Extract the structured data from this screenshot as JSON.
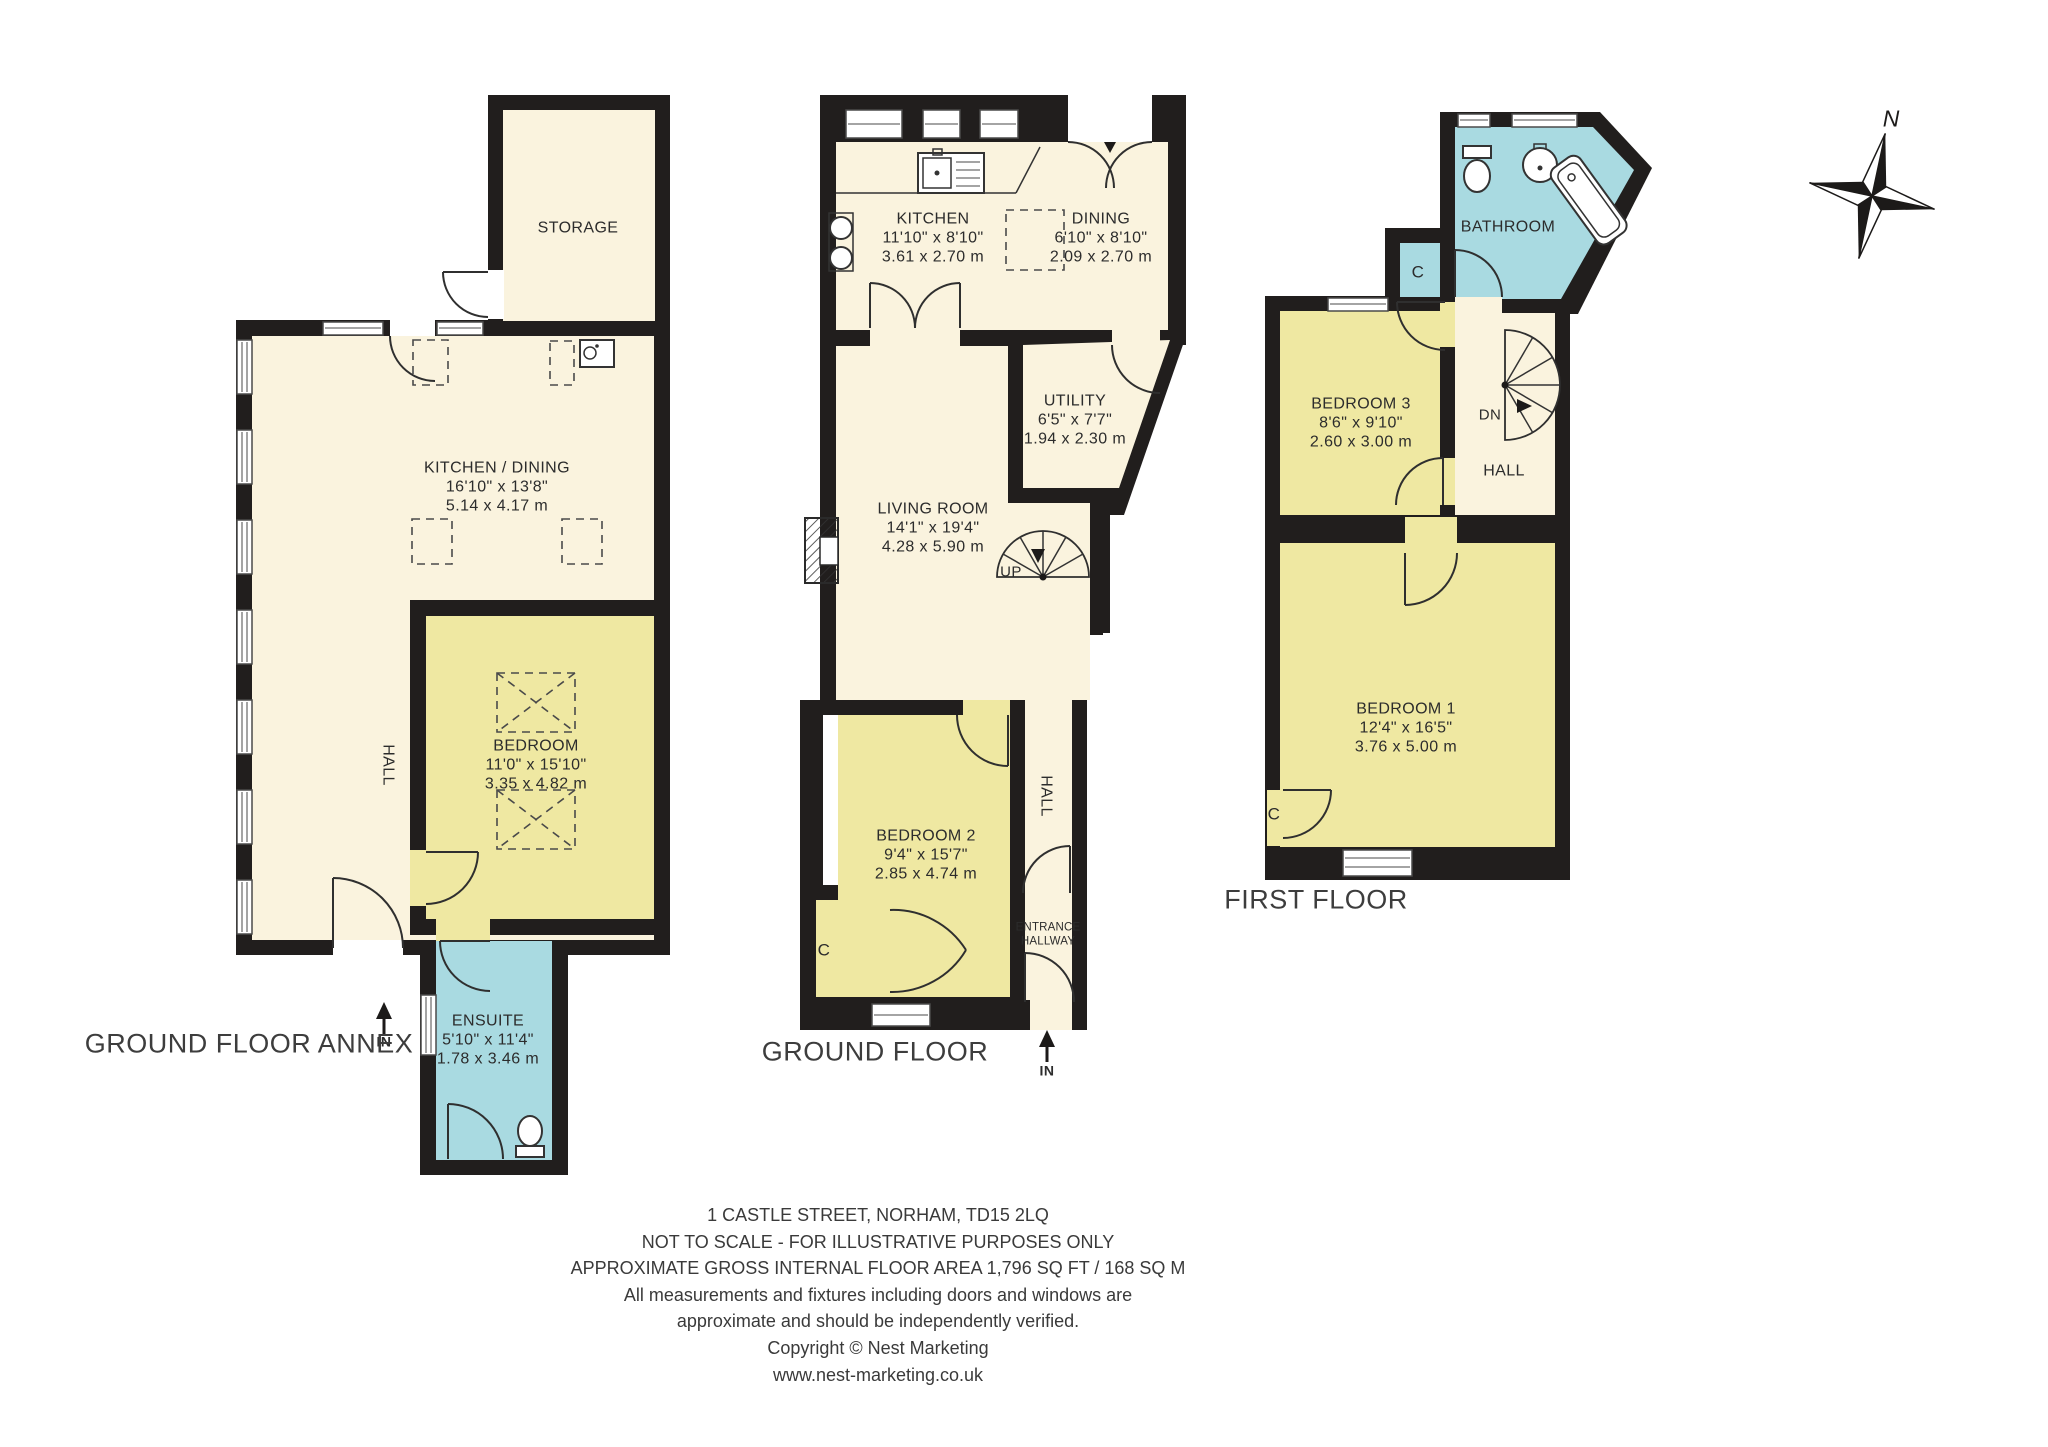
{
  "compass": {
    "north_label": "N"
  },
  "annex": {
    "title": "GROUND FLOOR ANNEX",
    "entry_label": "IN",
    "storage": {
      "name": "STORAGE"
    },
    "kitchen_dining": {
      "name": "KITCHEN / DINING",
      "size_imperial": "16'10\" x 13'8\"",
      "size_metric": "5.14 x 4.17 m"
    },
    "hall": {
      "name": "HALL"
    },
    "bedroom": {
      "name": "BEDROOM",
      "size_imperial": "11'0\" x 15'10\"",
      "size_metric": "3.35 x 4.82 m"
    },
    "ensuite": {
      "name": "ENSUITE",
      "size_imperial": "5'10\" x 11'4\"",
      "size_metric": "1.78 x 3.46 m"
    }
  },
  "ground": {
    "title": "GROUND FLOOR",
    "entry_label": "IN",
    "stairs_label": "UP",
    "closet_label": "C",
    "kitchen": {
      "name": "KITCHEN",
      "size_imperial": "11'10\" x 8'10\"",
      "size_metric": "3.61 x 2.70 m"
    },
    "dining": {
      "name": "DINING",
      "size_imperial": "6'10\" x 8'10\"",
      "size_metric": "2.09 x 2.70 m"
    },
    "utility": {
      "name": "UTILITY",
      "size_imperial": "6'5\" x 7'7\"",
      "size_metric": "1.94 x 2.30 m"
    },
    "living_room": {
      "name": "LIVING ROOM",
      "size_imperial": "14'1\" x 19'4\"",
      "size_metric": "4.28 x 5.90 m"
    },
    "bedroom2": {
      "name": "BEDROOM 2",
      "size_imperial": "9'4\" x 15'7\"",
      "size_metric": "2.85 x 4.74 m"
    },
    "hall": {
      "name": "HALL"
    },
    "entrance_hallway": {
      "name": "ENTRANCE HALLWAY"
    }
  },
  "first": {
    "title": "FIRST FLOOR",
    "stairs_label": "DN",
    "closet_label_1": "C",
    "closet_label_2": "C",
    "bathroom": {
      "name": "BATHROOM"
    },
    "hall": {
      "name": "HALL"
    },
    "bedroom3": {
      "name": "BEDROOM 3",
      "size_imperial": "8'6\" x 9'10\"",
      "size_metric": "2.60 x 3.00 m"
    },
    "bedroom1": {
      "name": "BEDROOM 1",
      "size_imperial": "12'4\" x 16'5\"",
      "size_metric": "3.76 x 5.00 m"
    }
  },
  "footer": {
    "lines": [
      "1 CASTLE STREET,  NORHAM, TD15 2LQ",
      "NOT TO SCALE - FOR ILLUSTRATIVE PURPOSES ONLY",
      "APPROXIMATE GROSS INTERNAL FLOOR AREA 1,796 SQ FT / 168 SQ M",
      "All measurements and fixtures including doors and windows are",
      "approximate and should be independently verified.",
      "Copyright © Nest Marketing",
      "www.nest-marketing.co.uk"
    ]
  }
}
